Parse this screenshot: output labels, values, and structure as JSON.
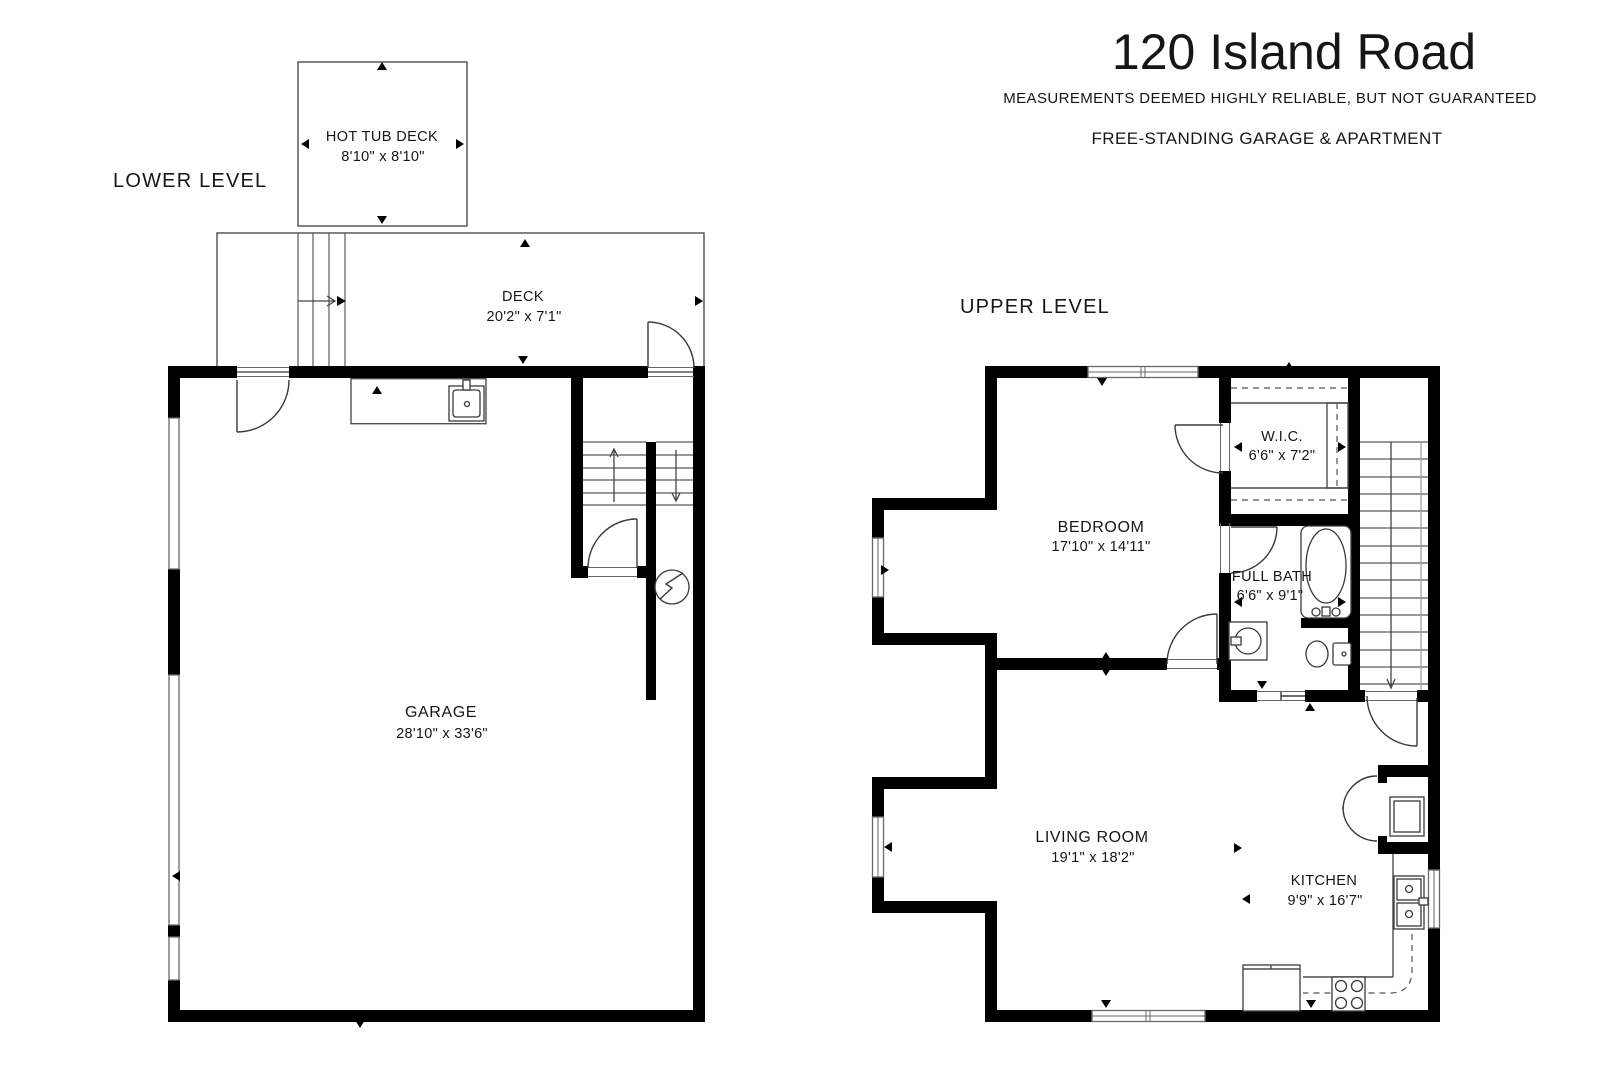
{
  "header": {
    "title": "120 Island Road",
    "disclaimer": "MEASUREMENTS DEEMED HIGHLY RELIABLE, BUT NOT GUARANTEED",
    "subtitle": "FREE-STANDING GARAGE & APARTMENT"
  },
  "levels": {
    "lower": {
      "label": "LOWER LEVEL"
    },
    "upper": {
      "label": "UPPER LEVEL"
    }
  },
  "rooms": {
    "hot_tub_deck": {
      "name": "HOT TUB DECK",
      "dims": "8'10\" x 8'10\""
    },
    "deck": {
      "name": "DECK",
      "dims": "20'2\" x 7'1\""
    },
    "garage": {
      "name": "GARAGE",
      "dims": "28'10\" x 33'6\""
    },
    "wic": {
      "name": "W.I.C.",
      "dims": "6'6\" x 7'2\""
    },
    "bedroom": {
      "name": "BEDROOM",
      "dims": "17'10\" x 14'11\""
    },
    "full_bath": {
      "name": "FULL BATH",
      "dims": "6'6\" x 9'1\""
    },
    "living_room": {
      "name": "LIVING ROOM",
      "dims": "19'1\" x 18'2\""
    },
    "kitchen": {
      "name": "KITCHEN",
      "dims": "9'9\" x 16'7\""
    }
  },
  "colors": {
    "wall": "#000000",
    "line": "#4d4d4d",
    "window_trim": "#6a6a6a",
    "background": "#ffffff"
  }
}
